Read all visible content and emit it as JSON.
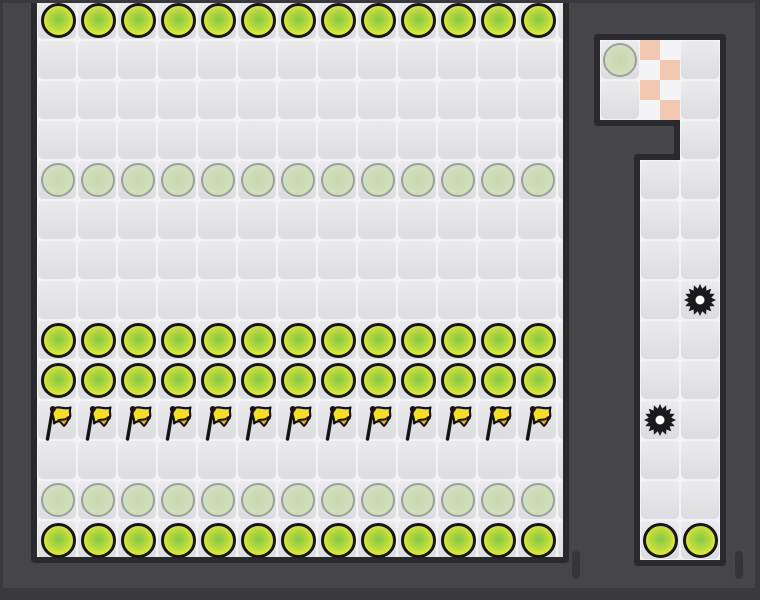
{
  "scene": {
    "type": "platformer-level-screenshot",
    "summary": {
      "yellow_coins": 54,
      "faded_coins": 27,
      "flags": 13,
      "saw_blades": 2,
      "checker_cells": 8
    }
  },
  "game": {
    "colors": {
      "bg": "#46464a",
      "frame": "#3a3a3e",
      "wall": "#2a2a2e",
      "tile_gap": "#f3f3f5",
      "tile_top": "#ebebee",
      "tile_bottom": "#dddde1",
      "coin_outline": "#161616",
      "coin_center": "#85c944",
      "coin_mid": "#b5d83e",
      "coin_edge": "#e7ea40",
      "coin_rim": "#eef254",
      "faded_outline": "#9aa09b",
      "faded_center": "#c7d8ae",
      "faded_edge": "#d7e2c5",
      "checker_pink": "#f2c8b0",
      "checker_light": "#f4f4f6",
      "flag_yellow": "#f6de26",
      "flag_orange": "#f6a827",
      "flag_black": "#141414",
      "saw": "#1a1a1d",
      "saw_hole": "#ffffff",
      "slit": "#35353a"
    },
    "tile_size": 40,
    "wall_rects": [
      {
        "x": 31,
        "y": -6,
        "w": 538,
        "h": 569
      },
      {
        "x": 594,
        "y": 34,
        "w": 132,
        "h": 92
      },
      {
        "x": 674,
        "y": 114,
        "w": 52,
        "h": 52
      },
      {
        "x": 634,
        "y": 154,
        "w": 92,
        "h": 412
      }
    ],
    "boards": [
      {
        "id": "main",
        "x": 37,
        "y": 0,
        "cols": 14,
        "rows": 14,
        "clip_w": 526,
        "clip_h": 557
      },
      {
        "id": "room",
        "x": 600,
        "y": 40,
        "cols": 3,
        "rows": 2
      },
      {
        "id": "neck",
        "x": 680,
        "y": 120,
        "cols": 1,
        "rows": 1
      },
      {
        "id": "corridor",
        "x": 640,
        "y": 160,
        "cols": 2,
        "rows": 10
      }
    ],
    "checker": {
      "x": 640,
      "y": 40,
      "w": 40,
      "h": 80
    },
    "main_origin": {
      "cx": 58,
      "cy": 20
    },
    "main_rows": [
      {
        "row": 0,
        "type": "coin",
        "count": 13
      },
      {
        "row": 4,
        "type": "coin-faded",
        "count": 13
      },
      {
        "row": 8,
        "type": "coin",
        "count": 13
      },
      {
        "row": 9,
        "type": "coin",
        "count": 13
      },
      {
        "row": 10,
        "type": "flag",
        "count": 13
      },
      {
        "row": 12,
        "type": "coin-faded",
        "count": 13
      },
      {
        "row": 13,
        "type": "coin",
        "count": 13
      }
    ],
    "side_entities": [
      {
        "type": "coin-faded",
        "cx": 620,
        "cy": 60
      },
      {
        "type": "saw",
        "cx": 700,
        "cy": 300
      },
      {
        "type": "saw",
        "cx": 660,
        "cy": 420
      },
      {
        "type": "coin",
        "cx": 660,
        "cy": 540
      },
      {
        "type": "coin",
        "cx": 700,
        "cy": 540
      }
    ],
    "slits": [
      {
        "x": 572,
        "y": 551
      },
      {
        "x": 735,
        "y": 551
      }
    ]
  }
}
